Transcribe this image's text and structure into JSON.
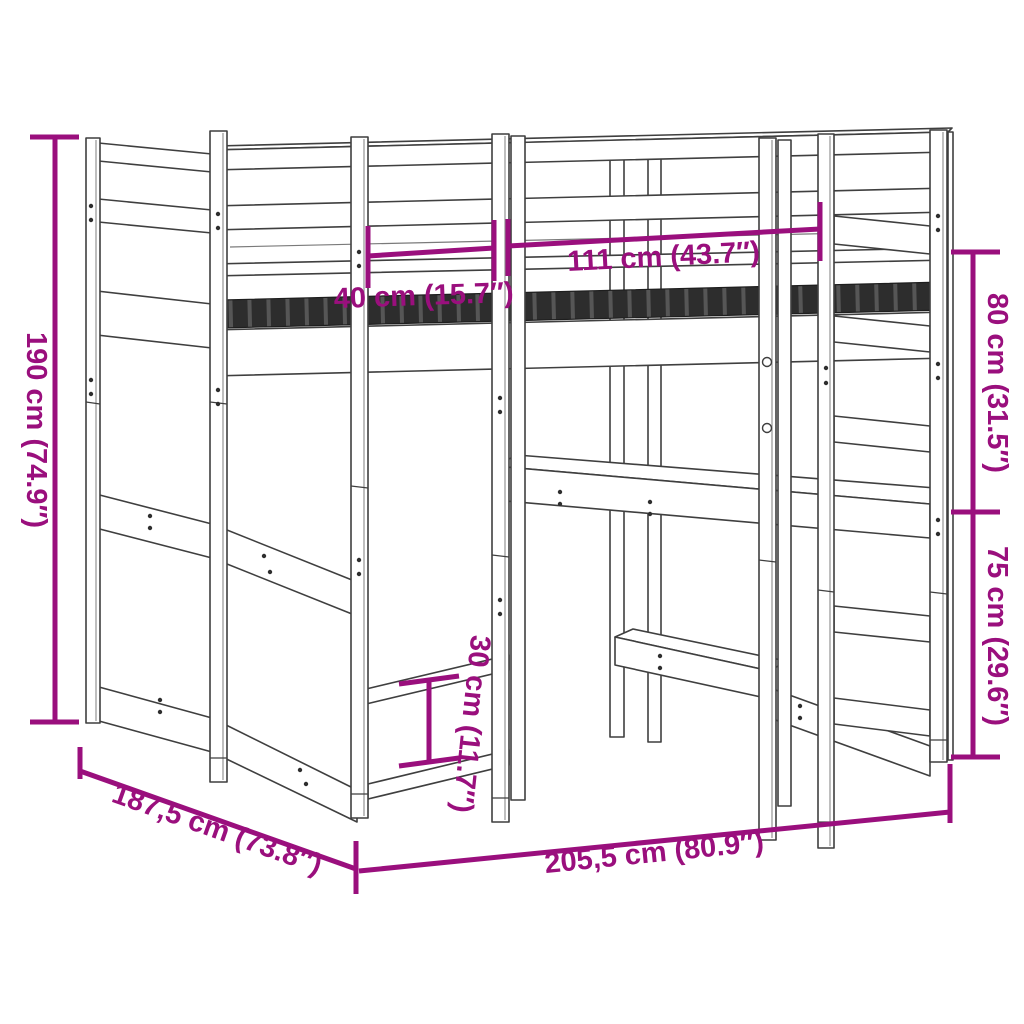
{
  "diagram": {
    "accent_color": "#9A0F7D",
    "outline_color": "#3F3F3F",
    "dimensions": {
      "height_total": {
        "label": "190 cm (74.9″)"
      },
      "top_left_width": {
        "label": "40 cm (15.7″)"
      },
      "top_center_width": {
        "label": "111 cm (43.7″)"
      },
      "right_upper_height": {
        "label": "80 cm (31.5″)"
      },
      "right_lower_height": {
        "label": "75 cm (29.6″)"
      },
      "center_shelf_gap": {
        "label": "30 cm (11.7″)"
      },
      "side_depth": {
        "label": "187,5 cm (73.8″)"
      },
      "front_width": {
        "label": "205,5 cm (80.9″)"
      }
    }
  }
}
